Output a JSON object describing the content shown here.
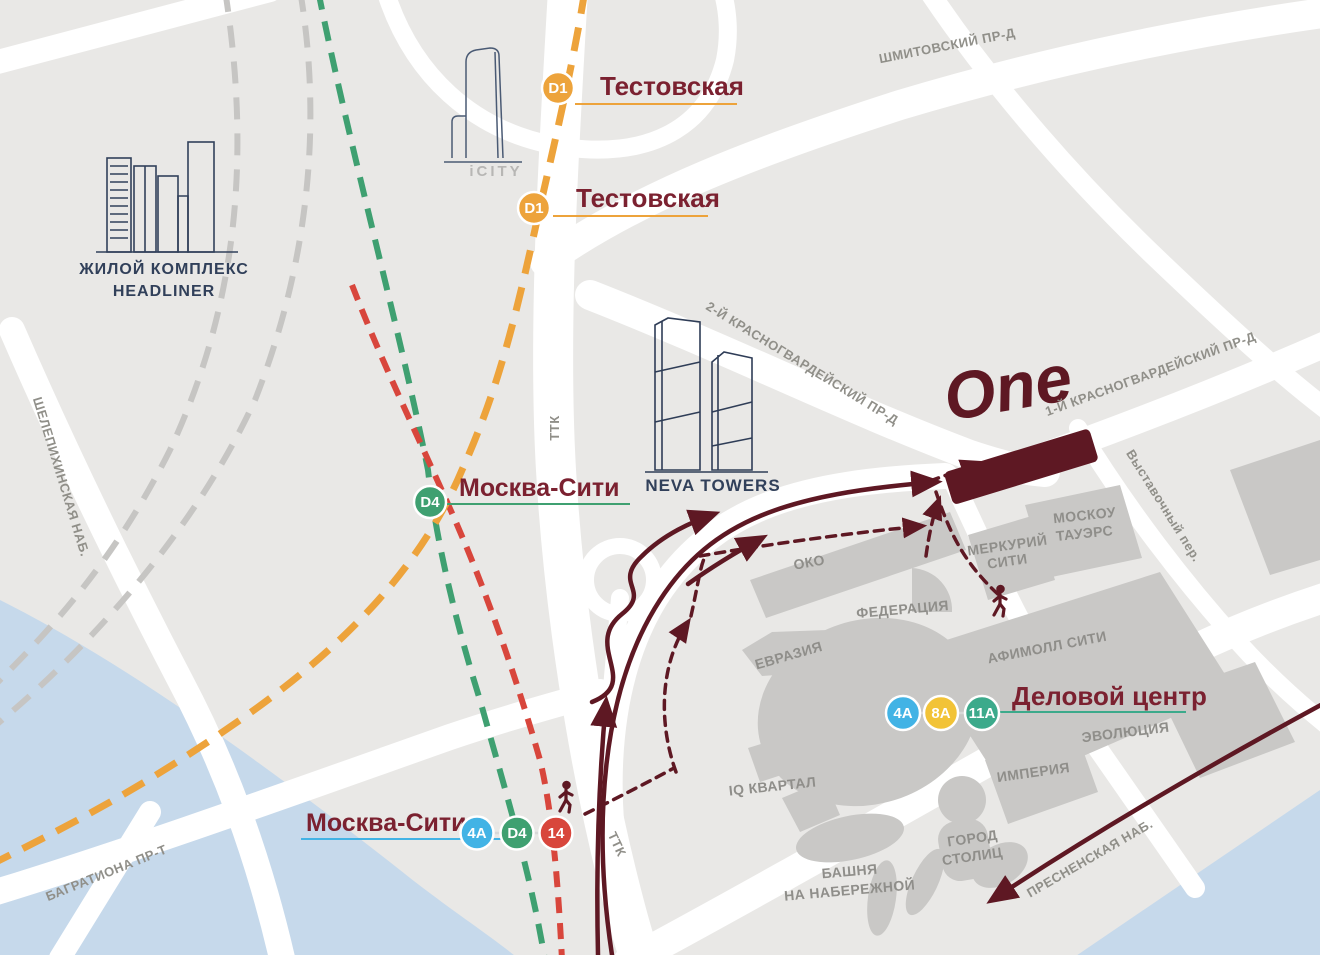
{
  "stations": {
    "testovskaya_top": {
      "name": "Тестовская",
      "badge": "D1"
    },
    "testovskaya_mid": {
      "name": "Тестовская",
      "badge": "D1"
    },
    "moskva_city_mid": {
      "name": "Москва-Сити",
      "badge": "D4"
    },
    "moskva_city_south": {
      "name": "Москва-Сити",
      "badge1": "4A",
      "badge2": "D4",
      "badge3": "14"
    },
    "delovoy_tsentr": {
      "name": "Деловой центр",
      "badge1": "4A",
      "badge2": "8A",
      "badge3": "11A"
    }
  },
  "streets": {
    "shmitovsky": "ШМИТОВСКИЙ ПР-Д",
    "krasnogvardeysky2": "2-Й КРАСНОГВАРДЕЙСКИЙ ПР-Д",
    "krasnogvardeysky1": "1-Й КРАСНОГВАРДЕЙСКИЙ ПР-Д",
    "vystavochny": "Выставочный пер.",
    "shelepikhinskaya": "ШЕЛЕПИХИНСКАЯ НАБ.",
    "bagrationa": "БАГРАТИОНА ПР-Т",
    "presnenskaya": "ПРЕСНЕНСКАЯ НАБ.",
    "ttk_north": "ТТК",
    "ttk_south": "ТТК"
  },
  "buildings": {
    "oko": "ОКО",
    "federatsiya": "ФЕДЕРАЦИЯ",
    "evraziya": "ЕВРАЗИЯ",
    "merkuriy_1": "МЕРКУРИЙ",
    "merkuriy_2": "СИТИ",
    "moskou_1": "МОСКОУ",
    "moskou_2": "ТАУЭРС",
    "afimall": "АФИМОЛЛ СИТИ",
    "evolyutsiya": "ЭВОЛЮЦИЯ",
    "imperiya": "ИМПЕРИЯ",
    "gorod_1": "ГОРОД",
    "gorod_2": "СТОЛИЦ",
    "bashnya_1": "БАШНЯ",
    "bashnya_2": "НА НАБЕРЕЖНОЙ",
    "iq": "IQ КВАРТАЛ"
  },
  "landmarks": {
    "headliner_1": "ЖИЛОЙ КОМПЛЕКС",
    "headliner_2": "HEADLINER",
    "icity": "iCITY",
    "neva": "NEVA TOWERS",
    "one": "One"
  },
  "colors": {
    "background": "#E9E8E6",
    "road": "#FFFFFF",
    "water": "#C6D9EB",
    "building_fill": "#C9C8C6",
    "brand_maroon": "#5E1823",
    "station_text": "#7B2130",
    "line_d1_orange": "#EDA33B",
    "line_d4_green": "#3FA071",
    "line_14_red": "#D8463C",
    "bus_4a_blue": "#42B3E5",
    "bus_8a_yellow": "#F2C337",
    "bus_11a_teal": "#3CAA8B",
    "rail_inactive_gray": "#C6C5C3"
  }
}
